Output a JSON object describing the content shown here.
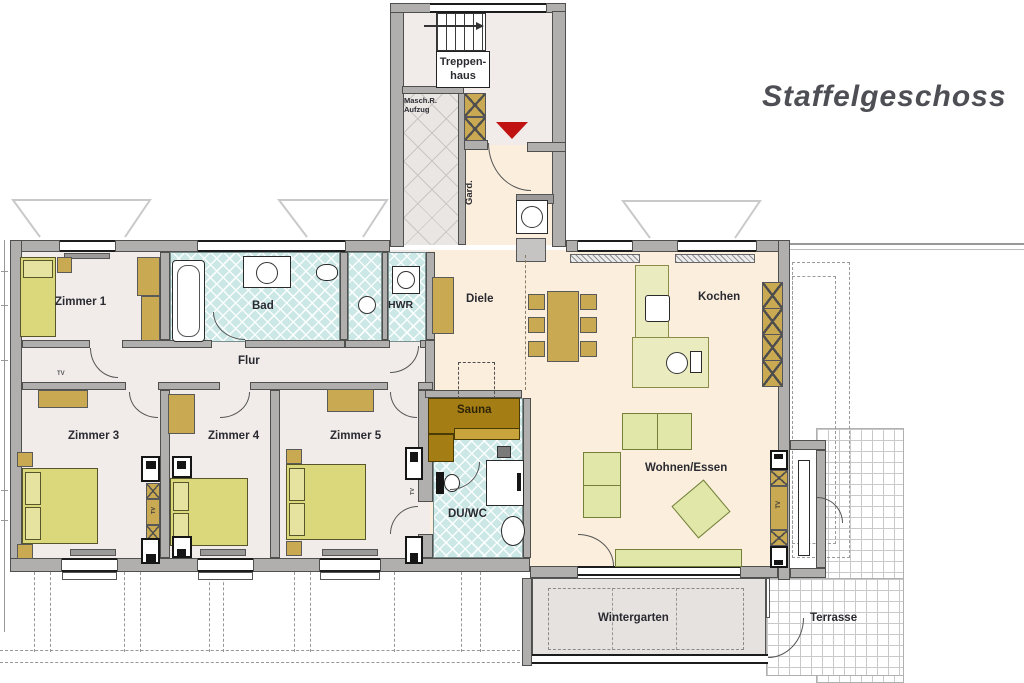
{
  "title": "Staffelgeschoss",
  "rooms": {
    "treppenhaus": "Treppen-\nhaus",
    "maschr": "Masch.R.\nAufzug",
    "gard": "Gard.",
    "diele": "Diele",
    "kochen": "Kochen",
    "wohnen_essen": "Wohnen/Essen",
    "zimmer1": "Zimmer 1",
    "bad": "Bad",
    "hwr": "HWR",
    "flur": "Flur",
    "zimmer3": "Zimmer 3",
    "zimmer4": "Zimmer 4",
    "zimmer5": "Zimmer 5",
    "sauna": "Sauna",
    "du_wc": "DU/WC",
    "wintergarten": "Wintergarten",
    "terrasse": "Terrasse"
  },
  "annotations": {
    "tv": "TV"
  },
  "colors": {
    "wall_gray": "#b1afad",
    "floor_rooms": "#f1ecea",
    "floor_living": "#fbeedd",
    "tile_teal": "#cbe8e7",
    "furniture_olive": "#dbd87c",
    "furniture_tan": "#c9aa52",
    "sofa_green": "#e0e7a9",
    "kitchen_pale": "#eaecc0",
    "sauna_brown": "#a57d15",
    "entrance_marker_red": "#c11212"
  }
}
